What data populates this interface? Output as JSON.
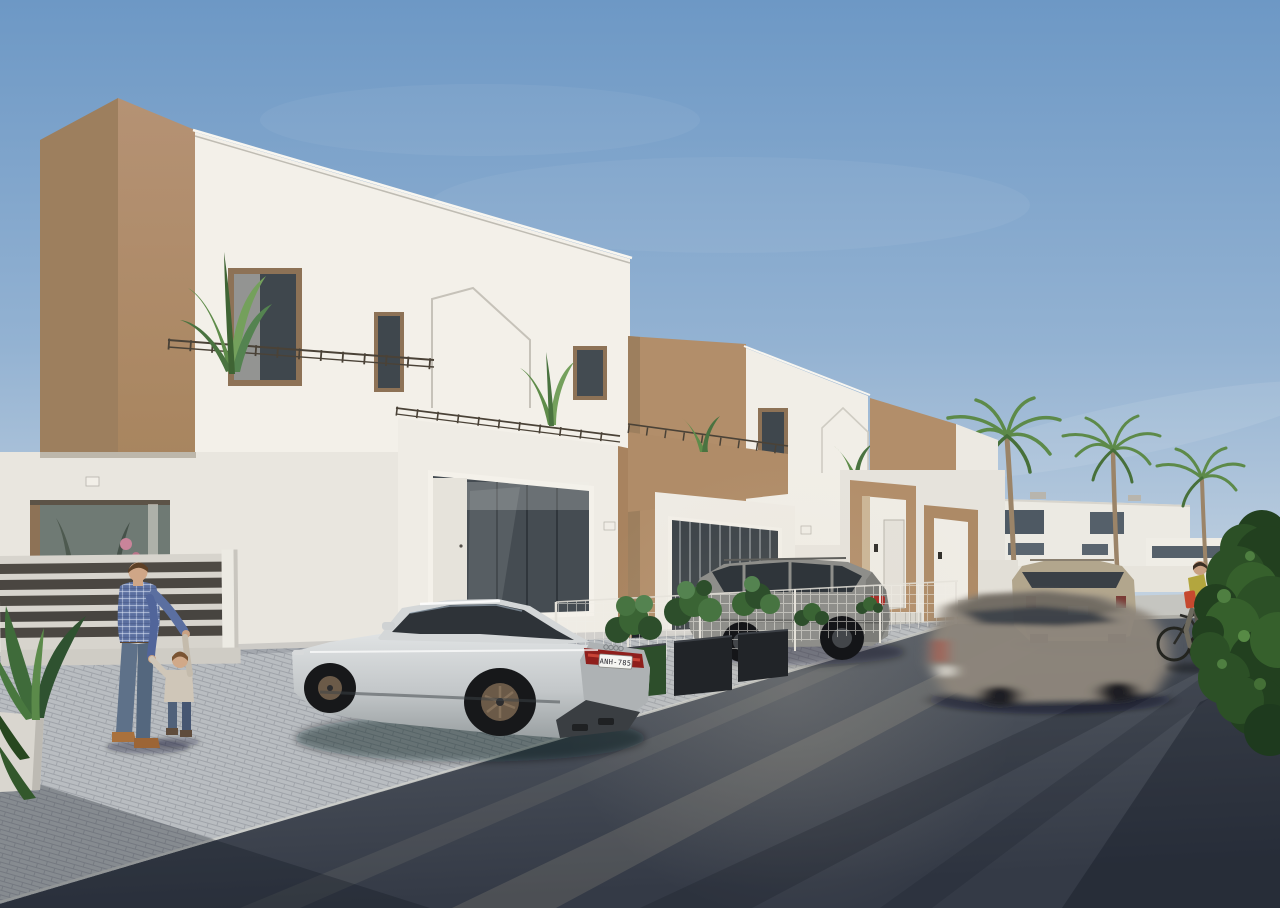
{
  "scene": {
    "type": "3d-architectural-visualization",
    "label": "Modern white and tan townhouse development street scene",
    "sky": "clear blue sky with faint cloud wisps",
    "lighting": "low warm sun casting long diagonal shadows across the street"
  },
  "palette": {
    "sky_top": "#6d98c5",
    "sky_mid": "#93b2d2",
    "sky_horizon": "#c7d5e2",
    "accent_tan_lit": "#b28e6a",
    "accent_tan_shade": "#9d7f5e",
    "wall_white_lit": "#f3f0e9",
    "wall_white_shade": "#e3e0d9",
    "asphalt_light": "#5a6068",
    "asphalt_dark": "#343a46",
    "paver": "#b9bdc1",
    "paver_joint": "#9fa3a9",
    "car_silver_hi": "#dfe2e3",
    "car_silver_lo": "#9aa0a2",
    "suv_gray": "#8e8e8a",
    "suv_beige": "#b2a68d",
    "taillight_red": "#b03028",
    "foliage_dark": "#2d4e2b",
    "palm_green": "#5d8a49",
    "denim_blue": "#5e7189",
    "plaid_shirt_blue": "#5b6fa0",
    "fence_wood": "#4e4a44",
    "frame_bronze": "#8d7256"
  },
  "objects": {
    "cars": {
      "audi": {
        "label": "silver sport sedan parked on paver driveway",
        "license_plate": "ANH-785",
        "wheels": "dark bronze rims"
      },
      "gray_suv": {
        "label": "gray SUV parked behind wire mesh fence"
      },
      "beige_suv": {
        "label": "beige SUV parked further down the street"
      },
      "moving_car": {
        "label": "motion-blurred car driving along the street"
      }
    },
    "people": {
      "man": {
        "label": "man in blue plaid shirt and jeans playing with toddler"
      },
      "toddler": {
        "label": "toddler holding the man's hands"
      },
      "cyclist": {
        "label": "cyclist in yellow top with orange bag riding along street"
      }
    },
    "buildings": {
      "townhouses": {
        "label": "row of modern two-storey white townhouses with tan accent volumes, terraces, railings and glazed garages",
        "visible_units": 4
      },
      "background_houses": {
        "label": "white modern houses behind palm trees"
      }
    },
    "vegetation": {
      "palm_trees": {
        "count": 3,
        "label": "tall palm trees along background street"
      },
      "banana_plants": {
        "label": "banana plants on the terraces"
      },
      "planter_shrubs": {
        "label": "black planter boxes with green shrubs between driveways"
      },
      "right_bush": {
        "label": "large dark green bush at right image edge"
      },
      "foreground_plant": {
        "label": "leafy plant in white planter at bottom left"
      }
    },
    "street": {
      "label": "dark asphalt street with light paver driveway apron and long diagonal shadows"
    }
  }
}
